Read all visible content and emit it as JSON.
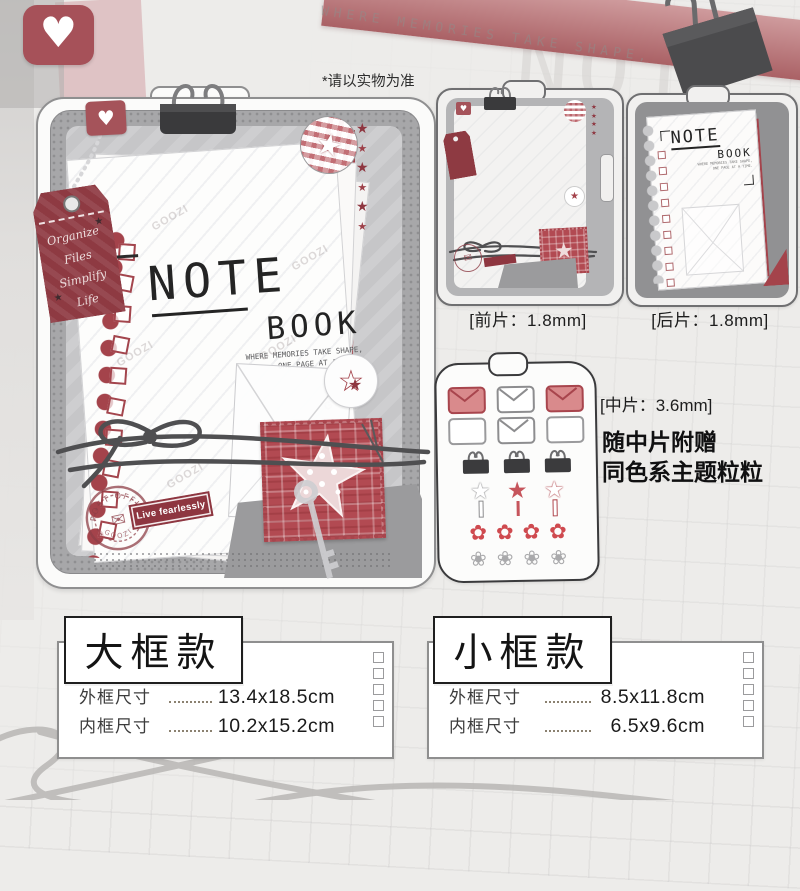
{
  "meta": {
    "disclaimer": "*请以实物为准",
    "bg_tagline": "WHERE MEMORIES TAKE SHAPE,",
    "ghost_word": "NOTE"
  },
  "glyphs": {
    "heart": "♥",
    "star": "★",
    "star_outline": "☆",
    "envelope": "✉",
    "flower": "✿",
    "flower_outline": "❀"
  },
  "main_product": {
    "tag_line1": "Organize",
    "tag_line2": "Files",
    "tag_line3": "Simplify",
    "tag_line4": "Life",
    "note_title": "NOTE",
    "note_sub": "BOOK",
    "note_tag1": "WHERE MEMORIES TAKE SHAPE,",
    "note_tag2": "ONE PAGE AT A TIME.",
    "stamp_top": "POST OFFICE",
    "stamp_bottom": "GOOZI",
    "label": "Live fearlessly",
    "watermark": "GOOZI"
  },
  "pieces": {
    "front": {
      "label": "[前片：1.8mm]"
    },
    "back": {
      "label": "[后片：1.8mm]",
      "note_title": "NOTE",
      "note_sub": "BOOK"
    },
    "middle": {
      "label": "[中片：3.6mm]",
      "note1": "随中片附赠",
      "note2": "同色系主题粒粒"
    }
  },
  "specs": [
    {
      "title": "大框款",
      "rows": [
        {
          "label": "外框尺寸",
          "value": "13.4x18.5cm"
        },
        {
          "label": "内框尺寸",
          "value": "10.2x15.2cm"
        }
      ]
    },
    {
      "title": "小框款",
      "rows": [
        {
          "label": "外框尺寸",
          "value": "8.5x11.8cm"
        },
        {
          "label": "内框尺寸",
          "value": "6.5x9.6cm"
        }
      ]
    }
  ],
  "colors": {
    "maroon": "#8e3640",
    "red": "#a4434b",
    "plaid_red": "#b24a52",
    "banner_pink": "#b4696d",
    "frame_gray": "#a7a7a9",
    "clip_dark": "#3b3b3d"
  }
}
